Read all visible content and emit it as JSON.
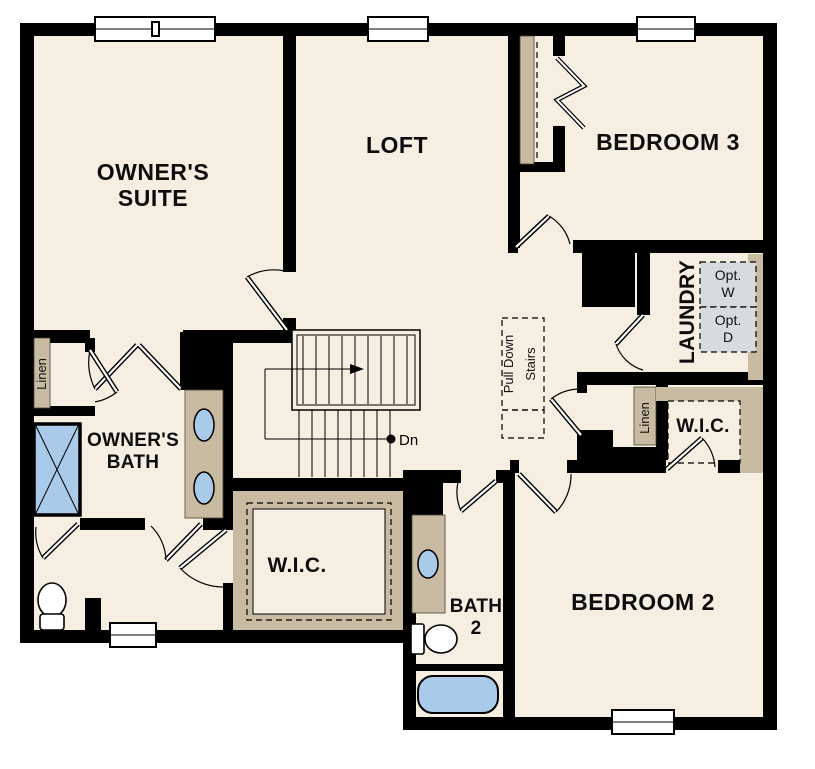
{
  "title": "Second floor plan",
  "colors": {
    "background": "#ffffff",
    "wall": "#000000",
    "floor": "#f6eee1",
    "casework_tan": "#c8bba2",
    "fixture_blue": "#a9cbe9",
    "appliance_gray": "#d8dbdd"
  },
  "rooms": {
    "owners_suite": {
      "line1": "OWNER'S",
      "line2": "SUITE"
    },
    "loft": {
      "label": "LOFT"
    },
    "bedroom3": {
      "label": "BEDROOM 3"
    },
    "laundry": {
      "label": "LAUNDRY",
      "opt_washer_line1": "Opt.",
      "opt_washer_line2": "W",
      "opt_dryer_line1": "Opt.",
      "opt_dryer_line2": "D"
    },
    "owners_bath": {
      "line1": "OWNER'S",
      "line2": "BATH"
    },
    "bath2": {
      "line1": "BATH",
      "line2": "2"
    },
    "bedroom2": {
      "label": "BEDROOM 2"
    }
  },
  "closets": {
    "linen_bath": {
      "label": "Linen"
    },
    "linen_hall": {
      "label": "Linen"
    },
    "wic_owners": {
      "label": "W.I.C."
    },
    "wic_bedroom2": {
      "label": "W.I.C."
    }
  },
  "stairs": {
    "down_label": "Dn",
    "pull_down_line1": "Pull Down",
    "pull_down_line2": "Stairs"
  },
  "icons": {
    "shower": "shower-stall-icon",
    "toilet": "toilet-icon",
    "sink": "sink-basin-icon",
    "bathtub": "bathtub-icon",
    "window": "window-icon",
    "door": "door-swing-icon",
    "bifold": "bifold-door-icon"
  }
}
